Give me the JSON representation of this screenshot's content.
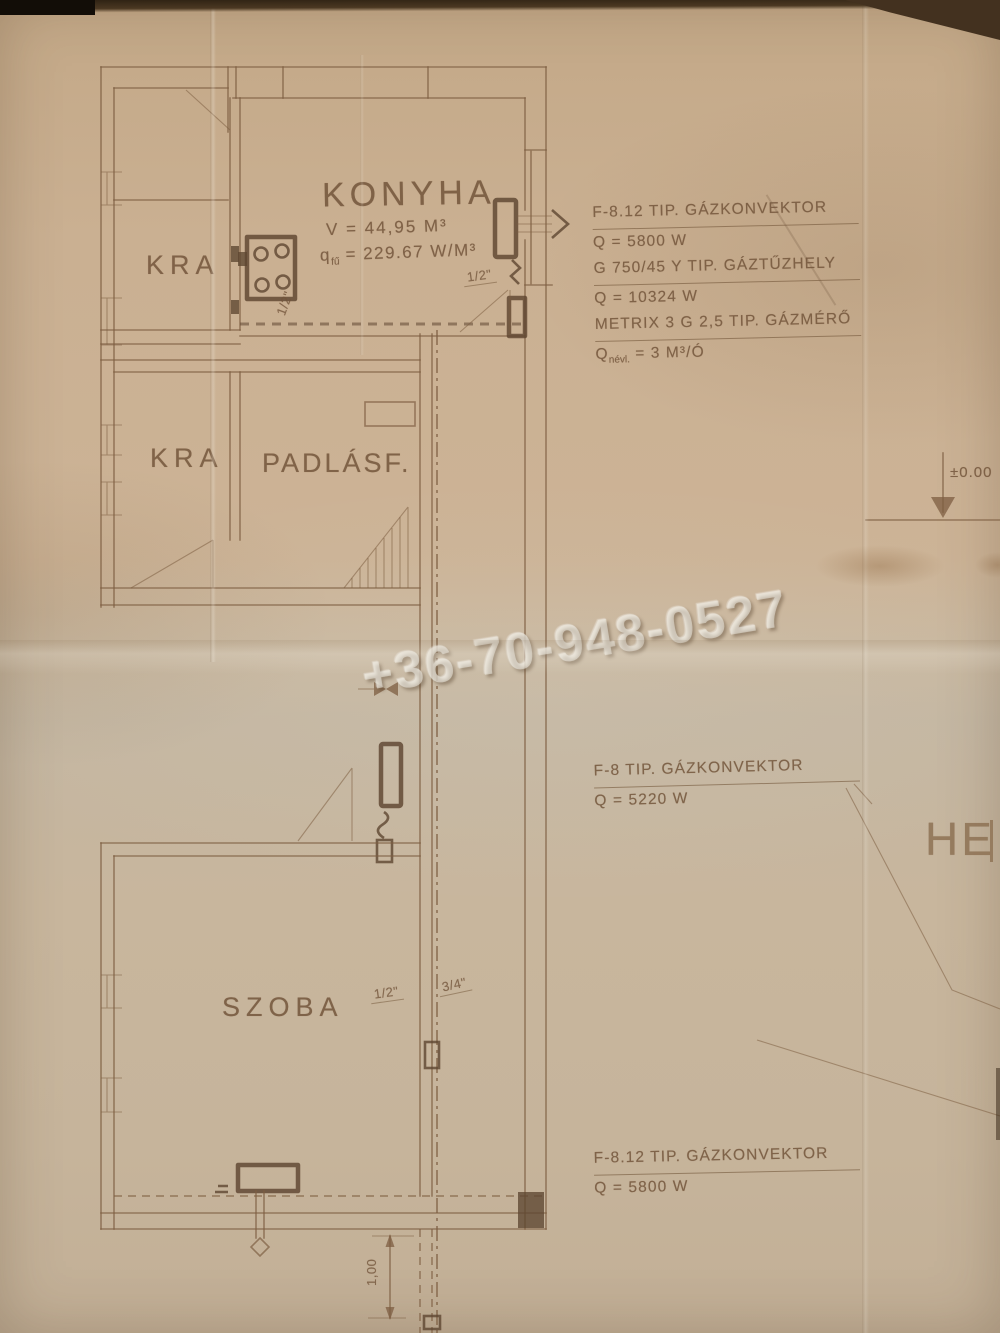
{
  "colors": {
    "paper": "#ccb396",
    "ink": "#72543a",
    "bold_ink": "#5e4631",
    "watermark": "#eee9df"
  },
  "watermark": {
    "phone": "+36-70-948-0527"
  },
  "rooms": {
    "konyha": {
      "name": "KONYHA",
      "volume": "V = 44,95 M³",
      "q": "q",
      "q_sub": "fű",
      "q_rest": " = 229.67 W/M³"
    },
    "kamra_top": {
      "name": "KRA"
    },
    "kamra_mid": {
      "name": "KRA"
    },
    "padlasfeljaro": {
      "name": "PADLÁSF."
    },
    "szoba": {
      "name": "SZOBA"
    }
  },
  "pipes": {
    "kitchen_branch": "1/2\"",
    "kitchen_riser": "1/2\"",
    "szoba_branch": "1/2\"",
    "szoba_riser": "3/4\"",
    "bottom_dimension": "1,00"
  },
  "annotations": {
    "kitchen_equipment": {
      "line1": "F-8.12 TIP. GÁZKONVEKTOR",
      "line2": "Q = 5800 W",
      "line3": "G 750/45 Y TIP. GÁZTŰZHELY",
      "line4": "Q = 10324 W",
      "line5": "METRIX 3 G 2,5 TIP. GÁZMÉRŐ",
      "line6_q": "Q",
      "line6_sub": "névl.",
      "line6_rest": " = 3 M³/Ó"
    },
    "hall_equipment": {
      "line1": "F-8 TIP. GÁZKONVEKTOR",
      "line2": "Q = 5220 W"
    },
    "szoba_equipment": {
      "line1": "F-8.12 TIP. GÁZKONVEKTOR",
      "line2": "Q = 5800 W"
    },
    "elevation": "±0.00",
    "partial_text": "HE"
  }
}
